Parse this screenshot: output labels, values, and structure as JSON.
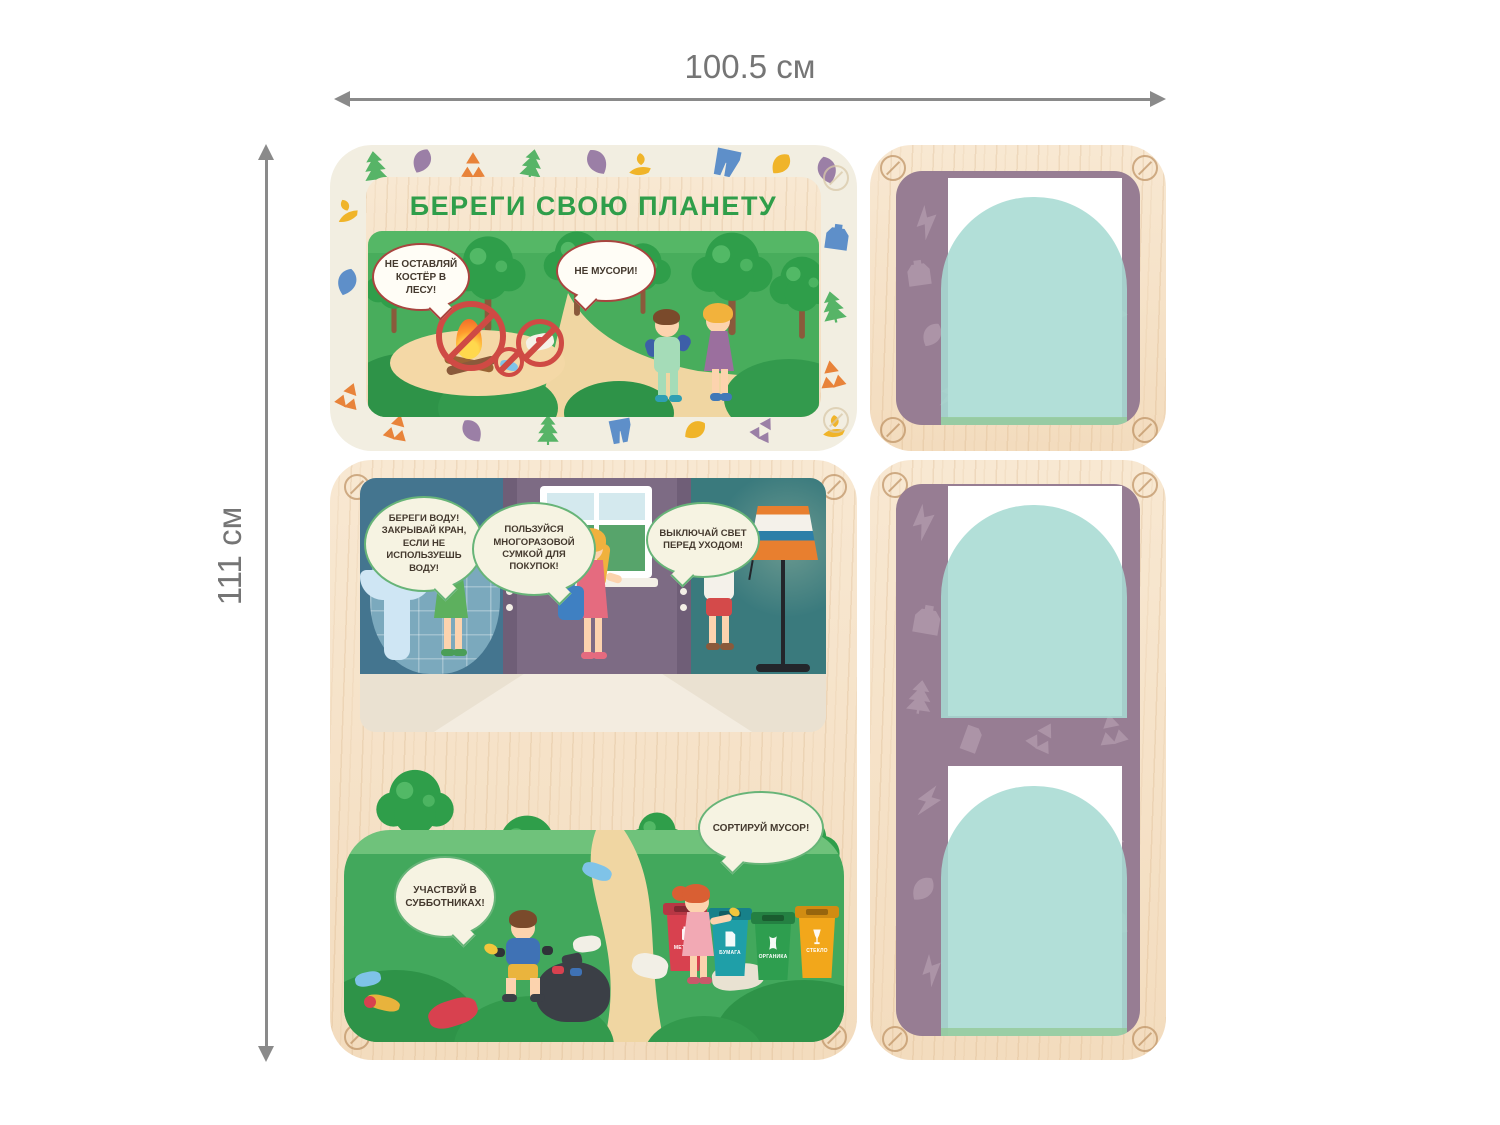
{
  "dimensions": {
    "width_label": "100.5 см",
    "height_label": "111 см"
  },
  "boards": {
    "title_board": {
      "title": "БЕРЕГИ СВОЮ ПЛАНЕТУ",
      "bubble_no_campfire": "НЕ ОСТАВЛЯЙ КОСТЁР В ЛЕСУ!",
      "bubble_no_litter": "НЕ МУСОРИ!"
    },
    "home_board": {
      "bubble_save_water": "БЕРЕГИ ВОДУ! ЗАКРЫВАЙ КРАН, ЕСЛИ НЕ ИСПОЛЬЗУЕШЬ ВОДУ!",
      "bubble_reusable_bag": "ПОЛЬЗУЙСЯ МНОГОРАЗОВОЙ СУМКОЙ ДЛЯ ПОКУПОК!",
      "bubble_lights_off": "ВЫКЛЮЧАЙ СВЕТ ПЕРЕД УХОДОМ!"
    },
    "outdoor_board": {
      "bubble_cleanup": "УЧАСТВУЙ В СУББОТНИКАХ!",
      "bubble_sort": "СОРТИРУЙ МУСОР!",
      "bins": [
        {
          "label": "МЕТАЛЛ",
          "color": "#d8414f"
        },
        {
          "label": "БУМАГА",
          "color": "#1f9fa8"
        },
        {
          "label": "ОРГАНИКА",
          "color": "#2e9e4f"
        },
        {
          "label": "СТЕКЛО",
          "color": "#f2a71b"
        }
      ]
    },
    "pocket_boards": {
      "pocket_count": 3,
      "pocket_color": "#a7dbd3",
      "card_color": "#ffffff",
      "panel_color": "#977d93"
    }
  },
  "palette": {
    "wood": "#f6e4cb",
    "cream_border": "#f2eee1",
    "title_green": "#2f9e4a",
    "bubble_border_red": "#a8453f",
    "bubble_border_green": "#67b478",
    "grass": "#48ad5c",
    "dimension_gray": "#8a8a8a"
  },
  "icons": [
    "pine-tree-icon",
    "leaf-icon",
    "recycle-icon",
    "lightning-icon",
    "pants-icon",
    "canister-icon",
    "hand-leaf-icon",
    "screw-icon",
    "prohibition-icon",
    "battery-icon",
    "paper-icon",
    "organic-icon",
    "glass-icon"
  ]
}
